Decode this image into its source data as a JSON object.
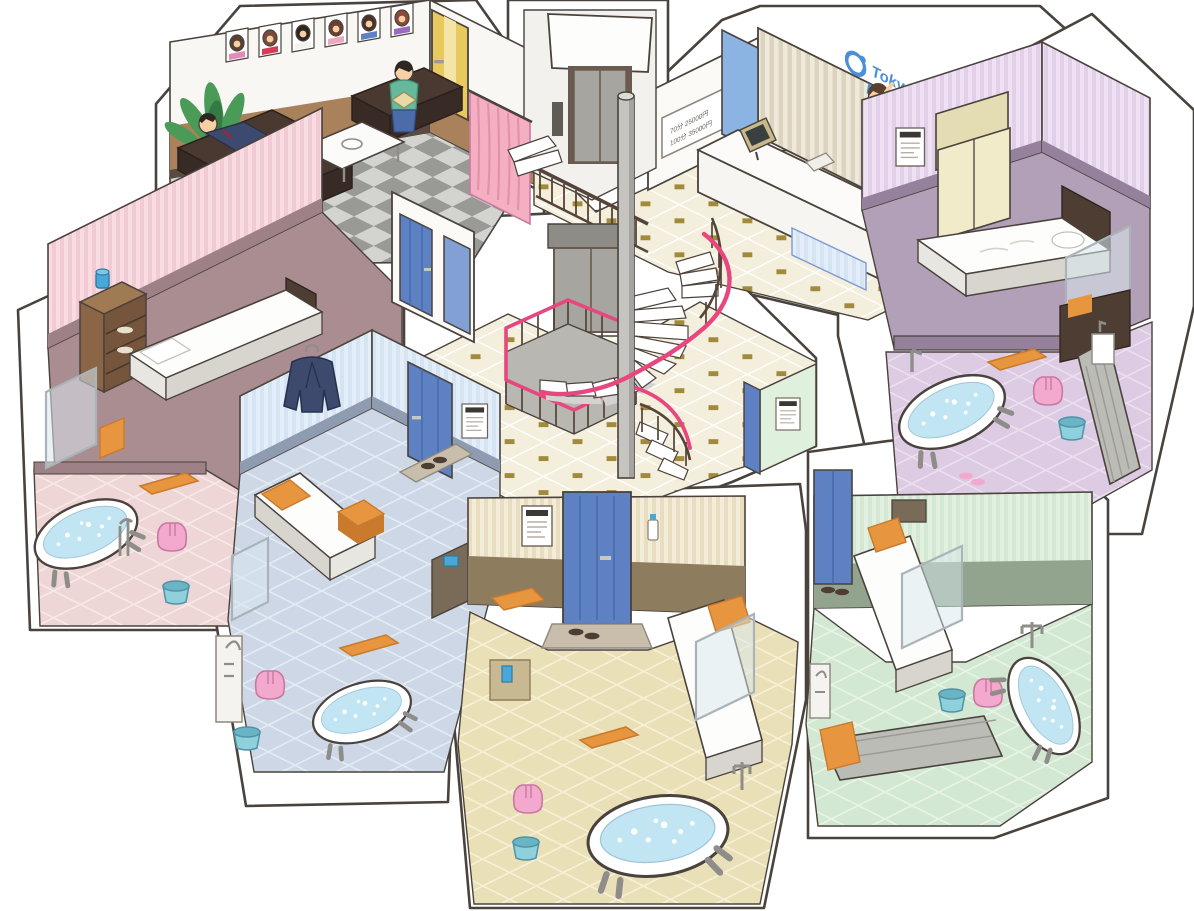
{
  "building": {
    "name": "Tokyo Bubblyland",
    "type": "isometric-cutaway-bathhouse-illustration"
  },
  "reception": {
    "sign_line1": "Tokyo",
    "sign_line2": "Bubblyland",
    "price_line1": "70分 25000円",
    "price_line2": "100分 35000円"
  },
  "palette": {
    "outline": "#4a423c",
    "matWhite": "#ffffff",
    "baseboard": "#5b4a42",
    "wood": "#8a6647",
    "checkerA": "#999996",
    "checkerB": "#d3d3d0",
    "loungeBrown": "#a9815a",
    "sofa": "#4a3931",
    "sofaDark": "#382b25",
    "tableWhite": "#fbfbf9",
    "plantGreen": "#4a9a58",
    "plantDark": "#357a44",
    "potBrown": "#8a5c3c",
    "doorYellow": "#e8c95e",
    "doorYellowLight": "#f4e4a8",
    "curtainPink": "#f4b0c2",
    "curtainPinkDark": "#e293ab",
    "stripeRecepA": "#efe9db",
    "stripeRecepB": "#ddd4bf",
    "bluePanel": "#8cb4e2",
    "signBlue": "#4a8fd8",
    "counterWhite": "#fcfbf9",
    "screenDark": "#3a3f3f",
    "lobbyCream": "#f4efdc",
    "lobbyGold": "#a08a3c",
    "railDark": "#554439",
    "railPink": "#e8467e",
    "pole": "#c6c4c0",
    "poleShade": "#a5a3a0",
    "stepWhite": "#ffffff",
    "stepSide": "#d5d3cf",
    "elevGray": "#a7a5a0",
    "elevFrame": "#6b5a50",
    "elevHeader": "#8e8c87",
    "purpleStripeA": "#eee2f2",
    "purpleStripeB": "#e2d0ea",
    "purpleBand": "#96819d",
    "purpleBedFloor": "#b2a0b8",
    "purpleTile": "#dccbe2",
    "purpleTileLine": "#ecdff0",
    "wardrobeCream": "#f1ebc9",
    "pinkStripeA": "#f8dce2",
    "pinkStripeB": "#f2cad4",
    "pinkBand": "#9d8186",
    "pinkBedFloor": "#aa8d91",
    "pinkTile": "#eed5d6",
    "pinkTileLine": "#f8e9e9",
    "blueStripeA": "#e4eef8",
    "blueStripeB": "#d4e4f3",
    "blueBand": "#8f9bb0",
    "blueTile": "#cdd7e6",
    "blueTileLine": "#e3ebf5",
    "navy": "#3e4a6d",
    "doorBlue": "#5d81c3",
    "doorBlueLight": "#82a0d4",
    "tanStripeA": "#f3ecd8",
    "tanStripeB": "#e9ddc0",
    "tanBand": "#8d7c5e",
    "tanTile": "#eae0b8",
    "tanTileLine": "#f6f0d6",
    "greenStripeA": "#e3f0e1",
    "greenStripeB": "#d2e8d0",
    "greenBand": "#93a48e",
    "greenTile": "#d3e8d2",
    "greenTileLine": "#e7f4e6",
    "tubWhite": "#ffffff",
    "water": "#c2e5f3",
    "stoolPink": "#f2a9cd",
    "stoolPinkDark": "#e38bb8",
    "bucketBlue": "#8fd0dd",
    "bucketBlueDark": "#6ab4c6",
    "towelOrange": "#e7953f",
    "towelOrangeDark": "#c97a2c",
    "bedWhite": "#fdfdfb",
    "bedBase": "#4e3d33",
    "mattressGray": "#bcbcb6",
    "glass": "#d8e7ee",
    "glassFrame": "#aab4b8",
    "skin": "#f6cfa4",
    "hairDark": "#2e2620",
    "hairBrown": "#5a4030",
    "suitNavy": "#3c4a70",
    "shirtTeal": "#67b99b",
    "shirtYellow": "#e7c457",
    "pantsBlue": "#4a6ca8",
    "pantsTan": "#9a8a6a",
    "bowtieRed": "#d63c55"
  }
}
